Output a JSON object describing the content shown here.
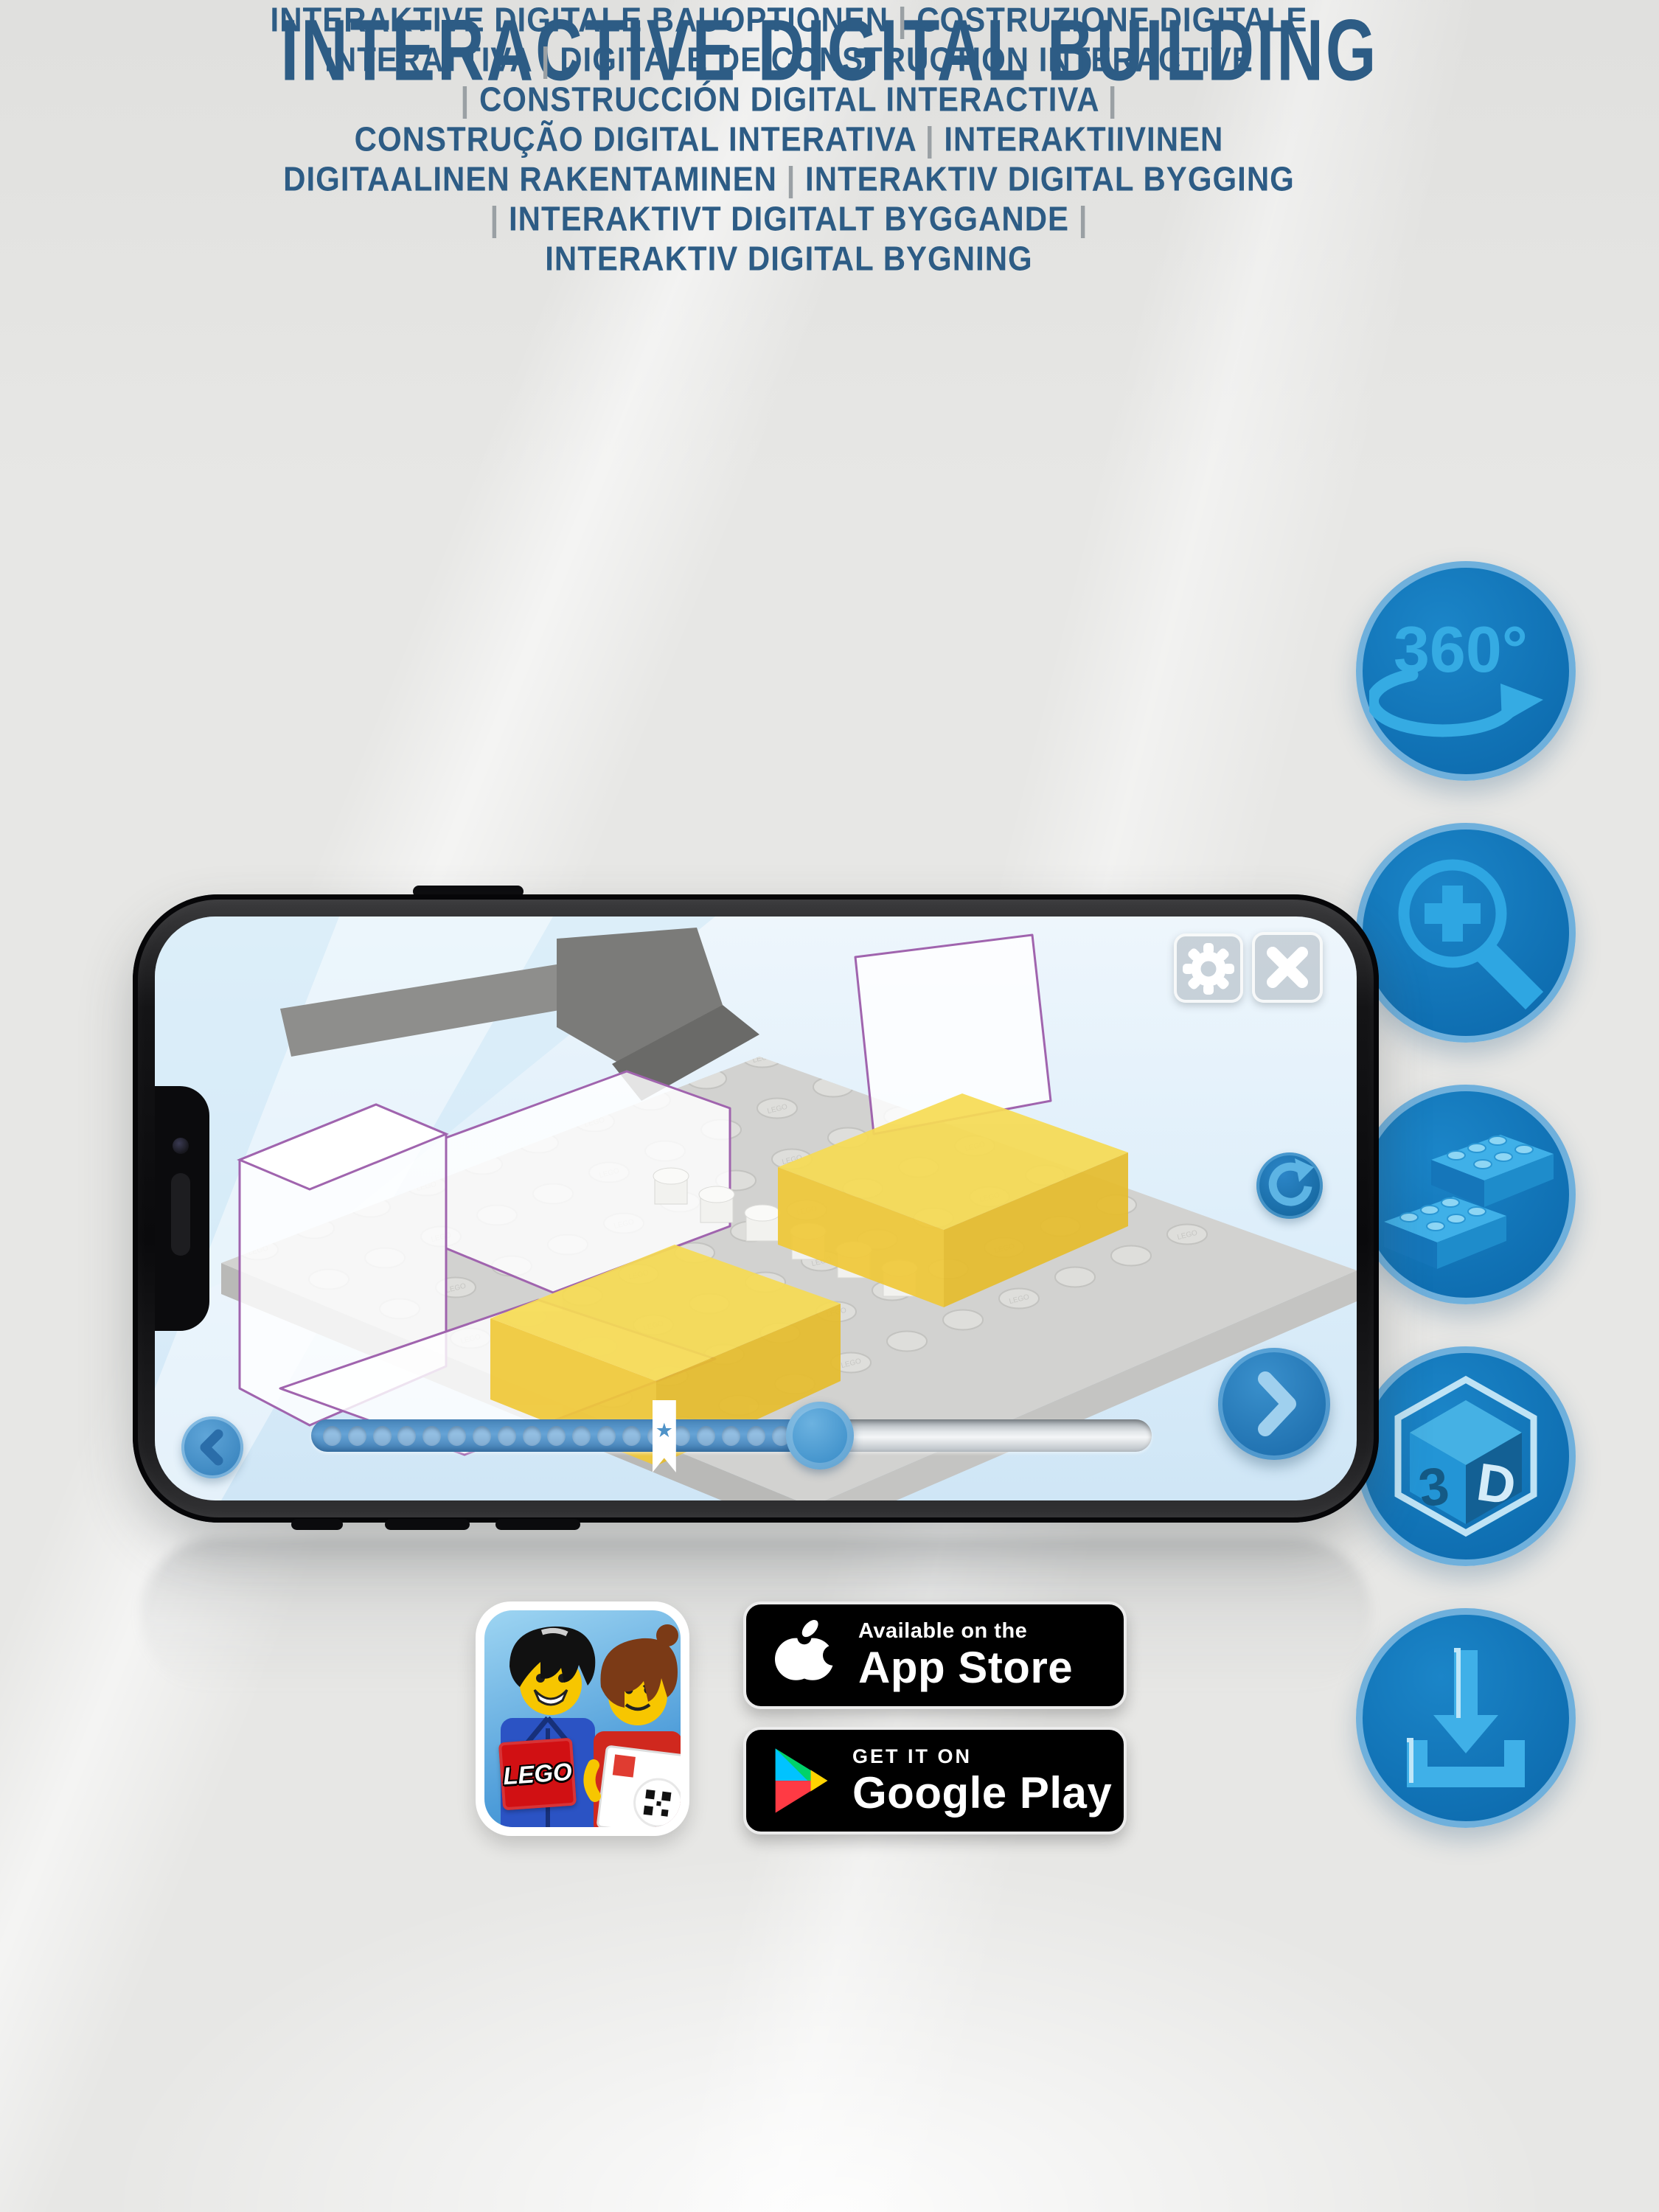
{
  "header": {
    "title": "INTERACTIVE DIGITAL BUILDING",
    "subtitle_lines": [
      "INTERAKTIVE DIGITALE BAUOPTIONEN | COSTRUZIONE DIGITALE",
      "INTERATTIVA | DIGITALE DE CONSTRUCTION INTERACTIVE",
      "| CONSTRUCCIÓN DIGITAL INTERACTIVA |",
      "CONSTRUÇÃO DIGITAL INTERATIVA | INTERAKTIIVINEN",
      "DIGITAALINEN RAKENTAMINEN | INTERAKTIV DIGITAL BYGGING",
      "| INTERAKTIVT DIGITALT BYGGANDE |",
      "INTERAKTIV DIGITAL BYGNING"
    ]
  },
  "features": {
    "rotate_360_label": "360°",
    "cube_letter_3": "3",
    "cube_letter_d": "D",
    "icon_names": [
      "360-rotation-icon",
      "zoom-in-icon",
      "brick-icon",
      "3d-view-icon",
      "download-icon"
    ]
  },
  "phone_app": {
    "stud_label": "LEGO",
    "progress": {
      "filled_pct": 64,
      "handle_pct": 60.5,
      "bookmark_pct": 42,
      "dot_count": 20,
      "bookmark_star": "★"
    }
  },
  "app_icon": {
    "lego_logo": "LEGO"
  },
  "badges": {
    "app_store": {
      "line1": "Available on the",
      "line2": "App Store"
    },
    "google_play": {
      "line1": "GET IT ON",
      "line2": "Google Play"
    }
  },
  "colors": {
    "title_text": "#2d5c85",
    "separator_gray": "#9aa0a4",
    "circle_fill": "#0f6fb2",
    "circle_rim": "#6fb0dc",
    "icon_glyph": "#2ea6e2",
    "lego_red": "#d11013",
    "screen_button_blue": "#2e84c4"
  }
}
